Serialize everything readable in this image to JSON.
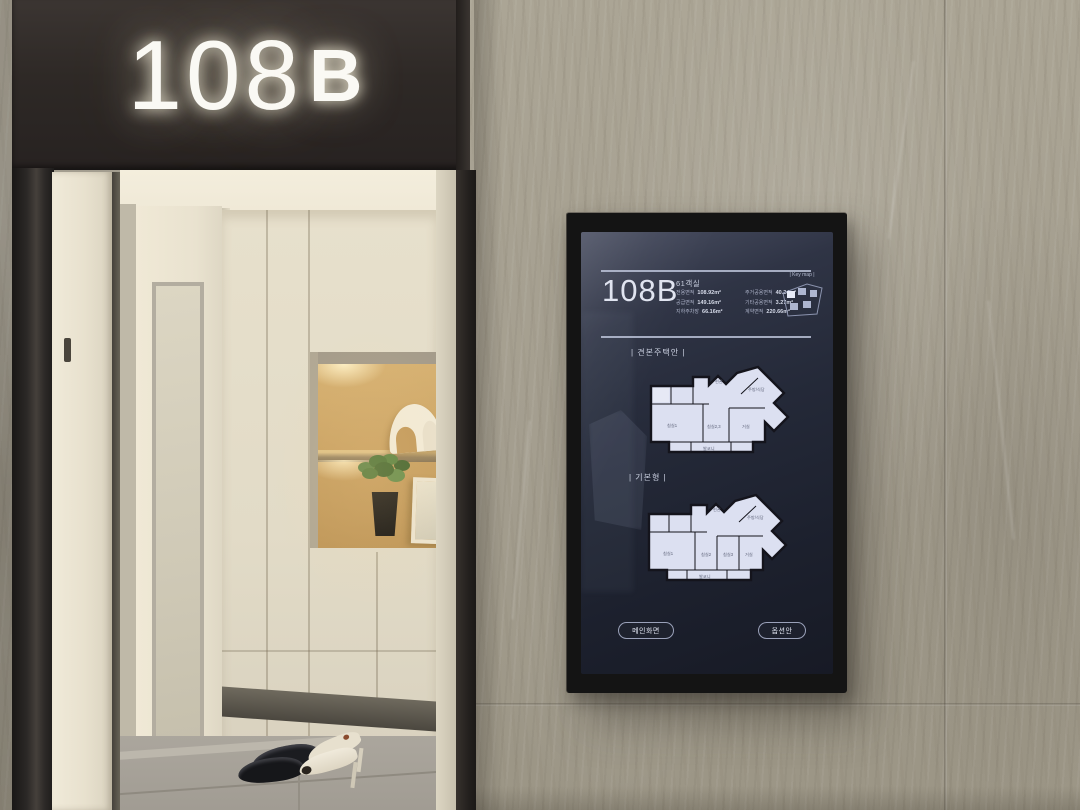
{
  "entrance": {
    "sign": {
      "number": "108",
      "letter": "B"
    }
  },
  "kiosk": {
    "header": {
      "title": "108B",
      "subtitle": "61객실",
      "area_left": [
        {
          "label": "전용면적",
          "value": "108.92m²"
        },
        {
          "label": "공급면적",
          "value": "149.16m²"
        },
        {
          "label": "지하주차장",
          "value": "66.16m²"
        }
      ],
      "area_right": [
        {
          "label": "주거공용면적",
          "value": "40.24m²"
        },
        {
          "label": "기타공용면적",
          "value": "3.27m²"
        },
        {
          "label": "계약면적",
          "value": "220.66m²"
        }
      ],
      "keymap_label": "| Key map |"
    },
    "sections": [
      {
        "label": "| 견본주택안 |"
      },
      {
        "label": "| 기본형 |"
      }
    ],
    "plans": {
      "rooms_a": {
        "bed1": "침실1",
        "bed23": "침실2,3",
        "living": "거실",
        "kitchen": "주방/식당",
        "entry": "현관",
        "balcony": "발코니"
      },
      "rooms_b": {
        "bed1": "침실1",
        "bed2": "침실2",
        "bed3": "침실3",
        "living": "거실",
        "kitchen": "주방/식당",
        "entry": "현관",
        "balcony": "발코니"
      }
    },
    "buttons": {
      "home": "메인화면",
      "option": "옵션안"
    },
    "colors": {
      "screen_bg": "#232838",
      "screen_text": "#ccd2e4",
      "plan_fill": "#dce0f1",
      "plan_wall": "#14141c",
      "sign_glow": "#fff6e0"
    }
  }
}
